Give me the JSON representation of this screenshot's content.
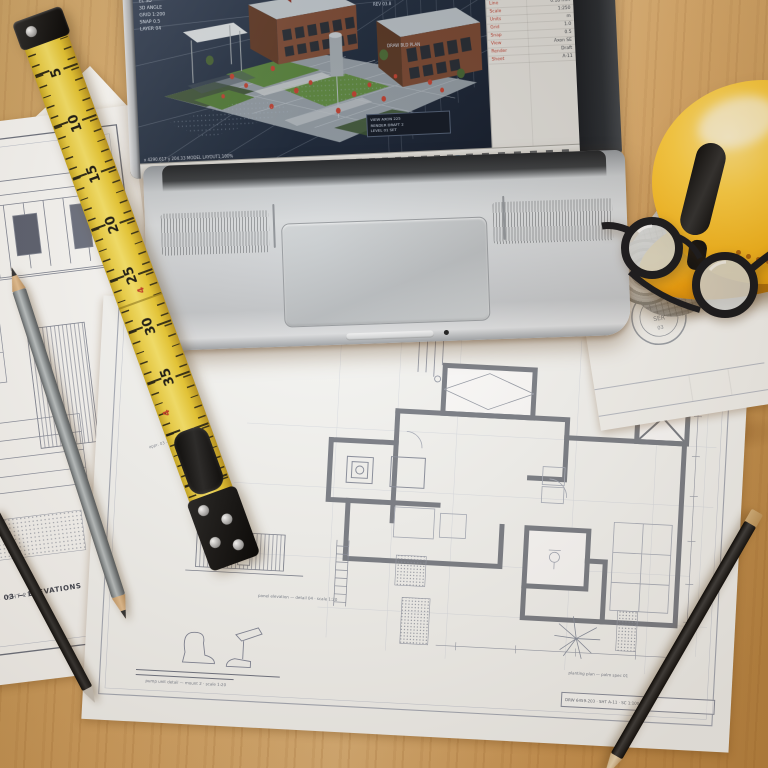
{
  "scene": {
    "label": "Architect's desk — laptop with CAD model, blueprints, measuring tools, hard hat"
  },
  "colors": {
    "hardhat_yellow": "#f7b71c",
    "ruler_yellow": "#f0d24a",
    "shrub_red": "#b5392a",
    "lawn_green": "#4e7a36",
    "wall_gray": "#7b8089",
    "desk_wood": "#dcae6e",
    "screen_navy": "#182538"
  },
  "screen": {
    "hud_lines": [
      "MODEL 8L05",
      "VIEW TRANSFORM",
      "EL 3D",
      "3D ANGLE",
      "GRID 1:200",
      "SNAP 0.5",
      "LAYER 04"
    ],
    "right_lines": [
      "PLAN LAYOUT",
      "SITE ZONE 2",
      "ANNOTATION LV1",
      "SCALE 1:250",
      "REV 03.8"
    ],
    "float_label": "DRAW BLD PLAN",
    "note_lines": [
      "VIEW AXON 225",
      "RENDER DRAFT 2",
      "LEVEL 01 SET"
    ],
    "status_text": "x 4290.617  y 204.33    MODEL  LAYOUT1  100%",
    "panel": {
      "header_left": "A1 · Rev0n",
      "header_right": "1-2676/6456",
      "rows": [
        {
          "label": "Name",
          "value": "A-201"
        },
        {
          "label": "Layer",
          "value": "0 walls"
        },
        {
          "label": "Color",
          "value": "ByLayer"
        },
        {
          "label": "Line",
          "value": "0.18 mm"
        },
        {
          "label": "Scale",
          "value": "1:250"
        },
        {
          "label": "Units",
          "value": "m"
        },
        {
          "label": "Grid",
          "value": "1.0"
        },
        {
          "label": "Snap",
          "value": "0.5"
        },
        {
          "label": "View",
          "value": "Axon SE"
        },
        {
          "label": "Render",
          "value": "Draft"
        },
        {
          "label": "Sheet",
          "value": "A-11"
        }
      ]
    }
  },
  "ruler": {
    "numbers": [
      "5",
      "10",
      "15",
      "20",
      "25",
      "30",
      "35"
    ],
    "red_marks": [
      "4",
      "4"
    ]
  },
  "paper_left": {
    "title_line1": "CAD SET 03 — ELEVATIONS",
    "title_line2": "SCALE 1:50 · SHT 214"
  },
  "paper_center": {
    "fence_caption": "panel elevation — detail 04 · scale 1:20",
    "machine_caption": "pump unit detail — mount 2 · scale 1:20",
    "palm_caption": "planting plan — palm spec 01",
    "title_block": "DRW 6459-203 · SHT A-11 · SC 1:100",
    "stamp_label": "APP",
    "stamp_note": "appr. 03 — site copy"
  },
  "paper_right": {
    "tag_label": "Awl",
    "seal_top": "✶",
    "seal_mid": "SER",
    "seal_bottom": "03"
  }
}
